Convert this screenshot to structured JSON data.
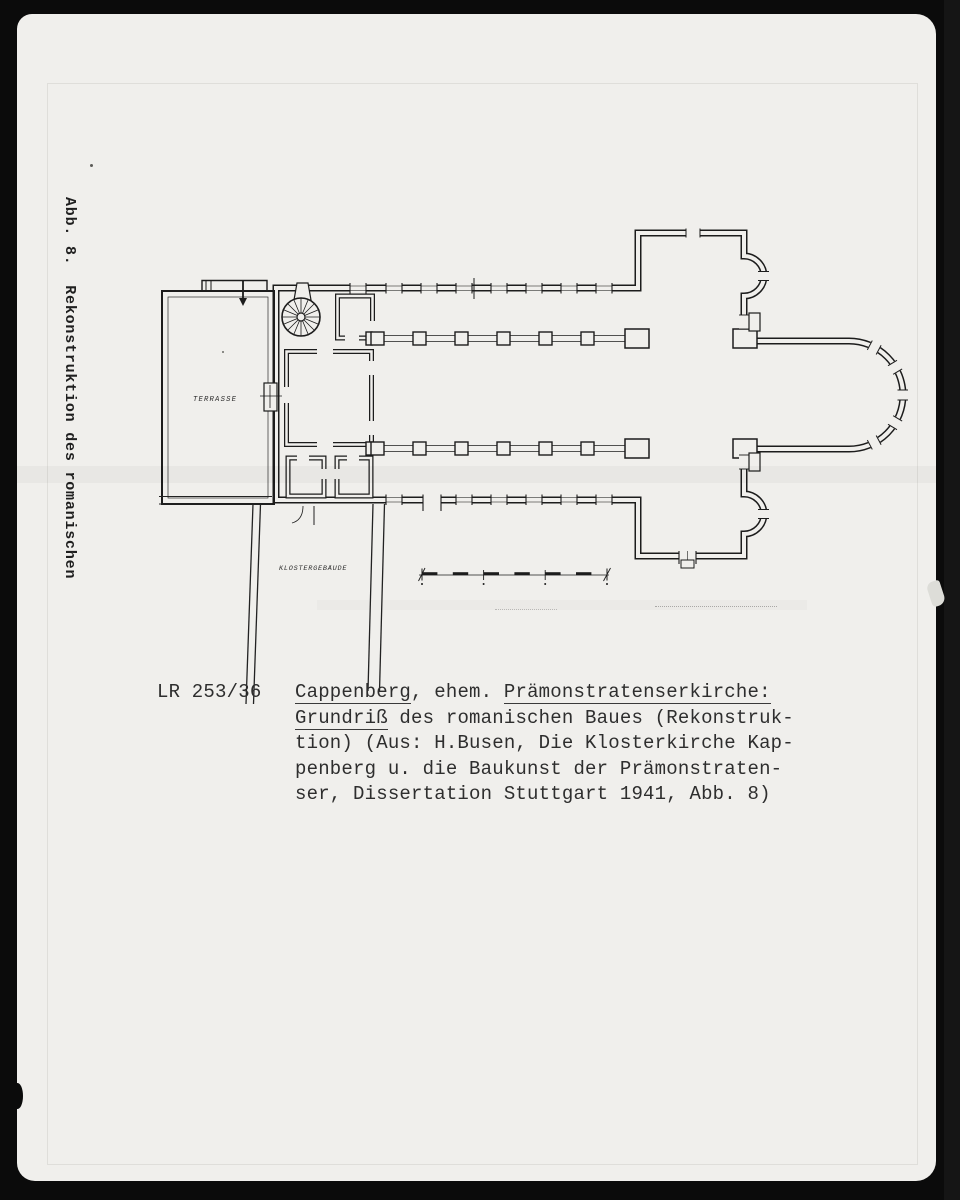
{
  "photo": {
    "side_label": {
      "line1": "Abb. 8.  Rekonstruktion des romanischen",
      "line2": "Grundrisses v. Kappenberg."
    },
    "plan": {
      "labels": {
        "terrasse": "TERRASSE",
        "klostergebaeude": "KLOSTERGEBÄUDE"
      }
    },
    "caption": {
      "catalog_number": "LR 253/36",
      "line1_part1": "Cappenberg",
      "line1_part2": ", ehem. ",
      "line1_part3": "Prämonstratenserkirche:",
      "line2_part1": "Grundriß",
      "line2_part2": " des romanischen Baues (Rekonstruk-",
      "line3": "tion) (Aus: H.Busen, Die Klosterkirche Kap-",
      "line4": "penberg u. die Baukunst der Prämonstraten-",
      "line5": "ser, Dissertation Stuttgart 1941, Abb. 8)"
    },
    "colors": {
      "film_border": "#0b0b0b",
      "paper": "#f0efec",
      "ink": "#1c1c1c"
    }
  }
}
